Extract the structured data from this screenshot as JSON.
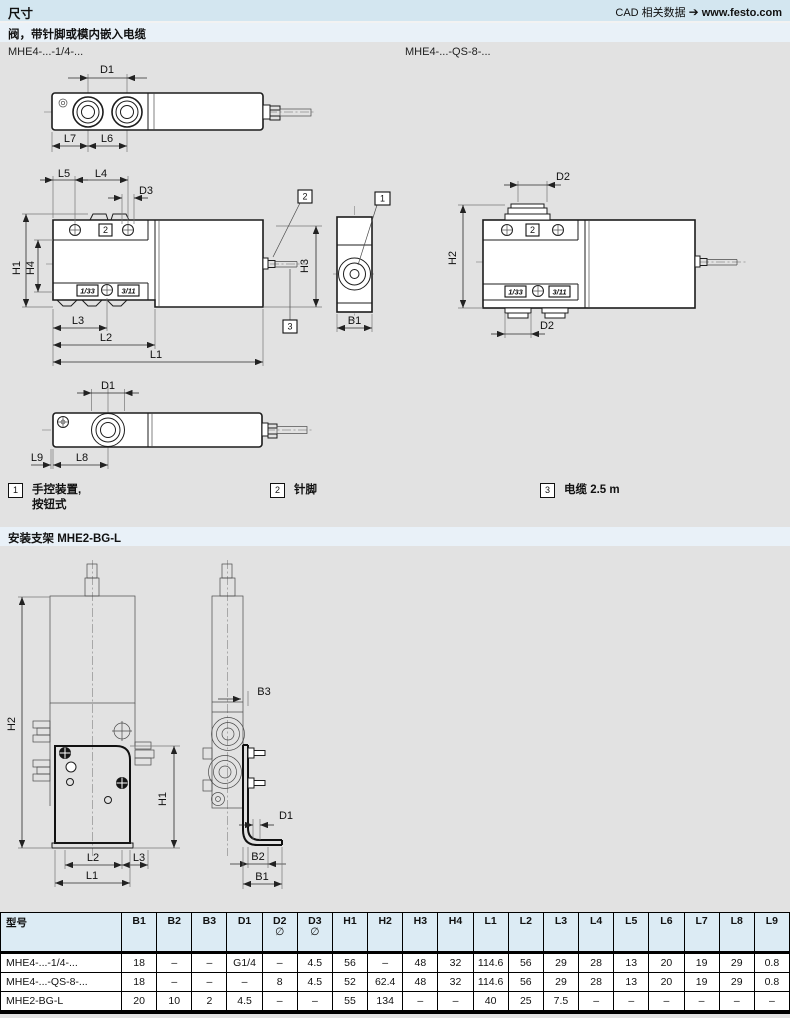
{
  "header": {
    "title": "尺寸",
    "cad_label": "CAD 相关数据",
    "arrow": "➔",
    "website": "www.festo.com"
  },
  "sections": {
    "valve": "阀，带针脚或模内嵌入电缆",
    "bracket": "安装支架 MHE2-BG-L"
  },
  "variants": {
    "left": "MHE4-...-1/4-...",
    "right": "MHE4-...-QS-8-..."
  },
  "dims": {
    "d1": "D1",
    "d2": "D2",
    "d3": "D3",
    "b1": "B1",
    "b2": "B2",
    "b3": "B3",
    "h1": "H1",
    "h2": "H2",
    "h3": "H3",
    "h4": "H4",
    "l1": "L1",
    "l2": "L2",
    "l3": "L3",
    "l4": "L4",
    "l5": "L5",
    "l6": "L6",
    "l7": "L7",
    "l8": "L8",
    "l9": "L9",
    "port_13": "1/33",
    "port_31": "3/11"
  },
  "refs": {
    "r1": "1",
    "r2": "2",
    "r3": "3"
  },
  "legend": {
    "items": [
      {
        "ref": "1",
        "text": "手控装置,",
        "text2": "按钮式"
      },
      {
        "ref": "2",
        "text": "针脚"
      },
      {
        "ref": "3",
        "text": "电缆 2.5 m"
      }
    ]
  },
  "table": {
    "dia": "∅",
    "columns": [
      "型号",
      "B1",
      "B2",
      "B3",
      "D1",
      "D2",
      "D3",
      "H1",
      "H2",
      "H3",
      "H4",
      "L1",
      "L2",
      "L3",
      "L4",
      "L5",
      "L6",
      "L7",
      "L8",
      "L9"
    ],
    "rows": [
      {
        "model": "MHE4-...-1/4-...",
        "values": [
          "18",
          "–",
          "–",
          "G1/4",
          "–",
          "4.5",
          "56",
          "–",
          "48",
          "32",
          "114.6",
          "56",
          "29",
          "28",
          "13",
          "20",
          "19",
          "29",
          "0.8"
        ]
      },
      {
        "model": "MHE4-...-QS-8-...",
        "values": [
          "18",
          "–",
          "–",
          "–",
          "8",
          "4.5",
          "52",
          "62.4",
          "48",
          "32",
          "114.6",
          "56",
          "29",
          "28",
          "13",
          "20",
          "19",
          "29",
          "0.8"
        ]
      },
      {
        "model": "MHE2-BG-L",
        "values": [
          "20",
          "10",
          "2",
          "4.5",
          "–",
          "–",
          "55",
          "134",
          "–",
          "–",
          "40",
          "25",
          "7.5",
          "–",
          "–",
          "–",
          "–",
          "–",
          "–"
        ]
      }
    ]
  }
}
